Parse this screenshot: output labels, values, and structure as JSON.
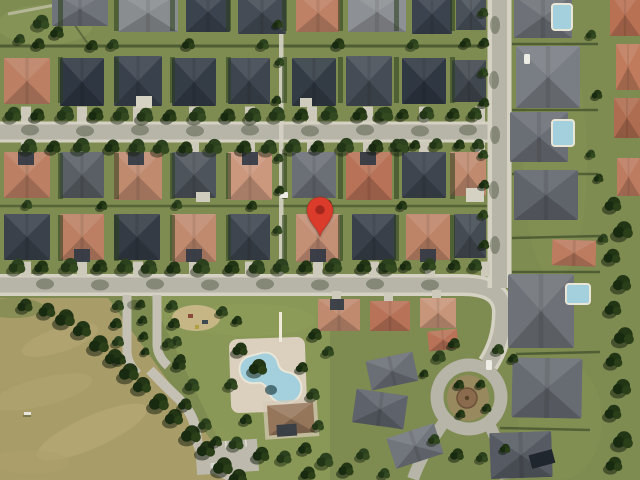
{
  "map": {
    "view": "satellite",
    "scene": "suburban residential neighborhood with community pool, park, field and cul-de-sac",
    "location_marker": {
      "shape": "teardrop-pin",
      "fill": "#DB3B2A",
      "dot": "#A3271C",
      "tip_x": 320,
      "tip_y": 237
    }
  },
  "palette": {
    "grass": "#7E8B51",
    "grass-light": "#93A05C",
    "field": "#A89C69",
    "road": "#B7B4A8",
    "road-light": "#C4C1B4",
    "sidewalk": "#D5D2C4",
    "concrete": "#CDC9BB",
    "roof-dark": "#353C47",
    "roof-gray": "#787C82",
    "roof-terracotta": "#C08A6F",
    "tree": "#2A3F1D",
    "pool": "#A3D0DC",
    "deck": "#DBCFBD",
    "clubhouse-roof": "#96765A"
  }
}
